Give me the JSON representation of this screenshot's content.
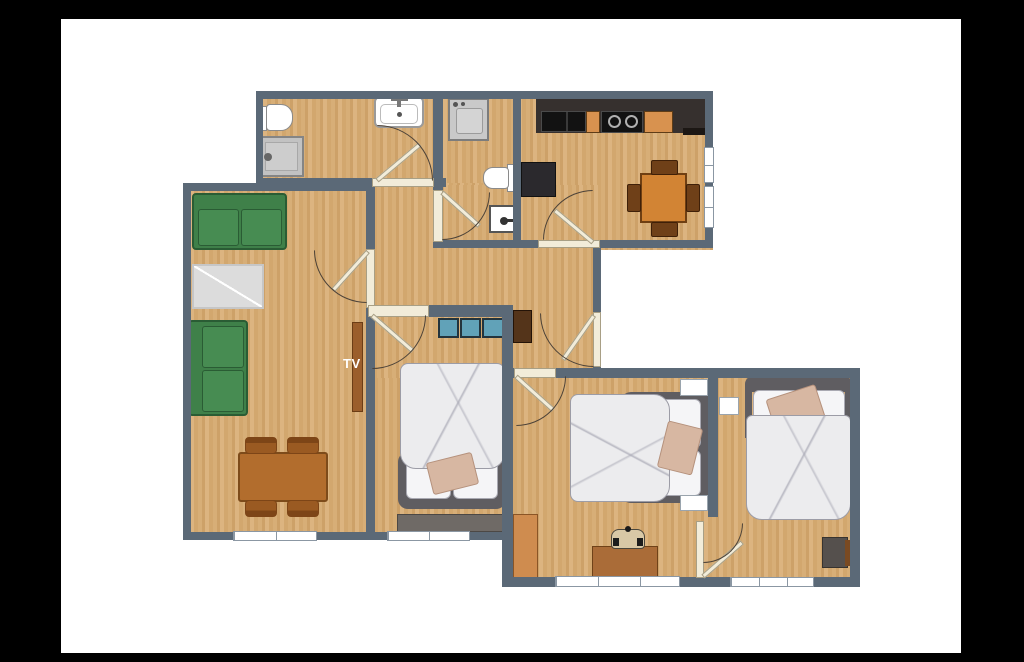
{
  "labels": {
    "tv": "TV"
  },
  "palette": {
    "wall": "#5b6977",
    "floorA": "#d7ae77",
    "floorB": "#cda168",
    "floorC": "#dcb480",
    "floorD": "#d2a76e",
    "green": "#3f8049",
    "greenDark": "#2a5c34",
    "greenLight": "#478c52",
    "rug": "#dcdcdc",
    "rugBorder": "#c6c6c6",
    "tableBrown": "#b26d2d",
    "tableBorder": "#7d4b1a",
    "chairBrown": "#9a5a22",
    "chairDark": "#7d4517",
    "counter": "#36302e",
    "appliance": "#121212",
    "orange": "#d8924f",
    "fridge": "#2b292d",
    "kitchenTable": "#d28434",
    "kitchenChair": "#6f4018",
    "teal": "#61a2b8",
    "tealBorder": "#23343d",
    "bedFrame": "#5f5d61",
    "duvet": "#ececee",
    "duvetLine": "#9c9ca6",
    "pillow": "#f5f5f7",
    "pillowBorder": "#a9a9b2",
    "accentPillow": "#d7b7a2",
    "accentBorder": "#b5917c",
    "grayFurn": "#6f6a66",
    "darkBrown": "#54341a",
    "deskWood": "#aa6c38",
    "deskChairSeat": "#d8c8a6",
    "chairGray": "#55504d",
    "armrestBrown": "#7a4a22",
    "cabinetOrange": "#cf8c4f",
    "door": "#f2ecd9",
    "doorBorder": "#a89f85",
    "arc": "#4c4238",
    "window": "#ffffff",
    "windowFrame": "#8b97a3",
    "tvStand": "#9b5e2b",
    "tvText": "#ffffff",
    "matte": "#000000",
    "background": "#ffffff"
  },
  "rooms": [
    {
      "id": "bathroom",
      "furniture": [
        "toilet",
        "shower",
        "washbasin"
      ]
    },
    {
      "id": "wc",
      "furniture": [
        "washing-machine",
        "toilet",
        "washbasin"
      ]
    },
    {
      "id": "kitchen",
      "furniture": [
        "counter",
        "sink",
        "stove",
        "refrigerator",
        "dining-table",
        "chairs"
      ]
    },
    {
      "id": "living-room",
      "furniture": [
        "sofa",
        "sofa",
        "rug",
        "tv-stand",
        "dining-table",
        "chairs"
      ]
    },
    {
      "id": "hallway",
      "furniture": [
        "cabinet"
      ]
    },
    {
      "id": "bedroom-1",
      "furniture": [
        "closet",
        "double-bed",
        "dresser"
      ]
    },
    {
      "id": "bedroom-2",
      "furniture": [
        "double-bed",
        "nightstand",
        "nightstand",
        "wardrobe",
        "desk",
        "desk-chair"
      ]
    },
    {
      "id": "bedroom-3",
      "furniture": [
        "double-bed",
        "nightstand",
        "armchair"
      ]
    }
  ]
}
